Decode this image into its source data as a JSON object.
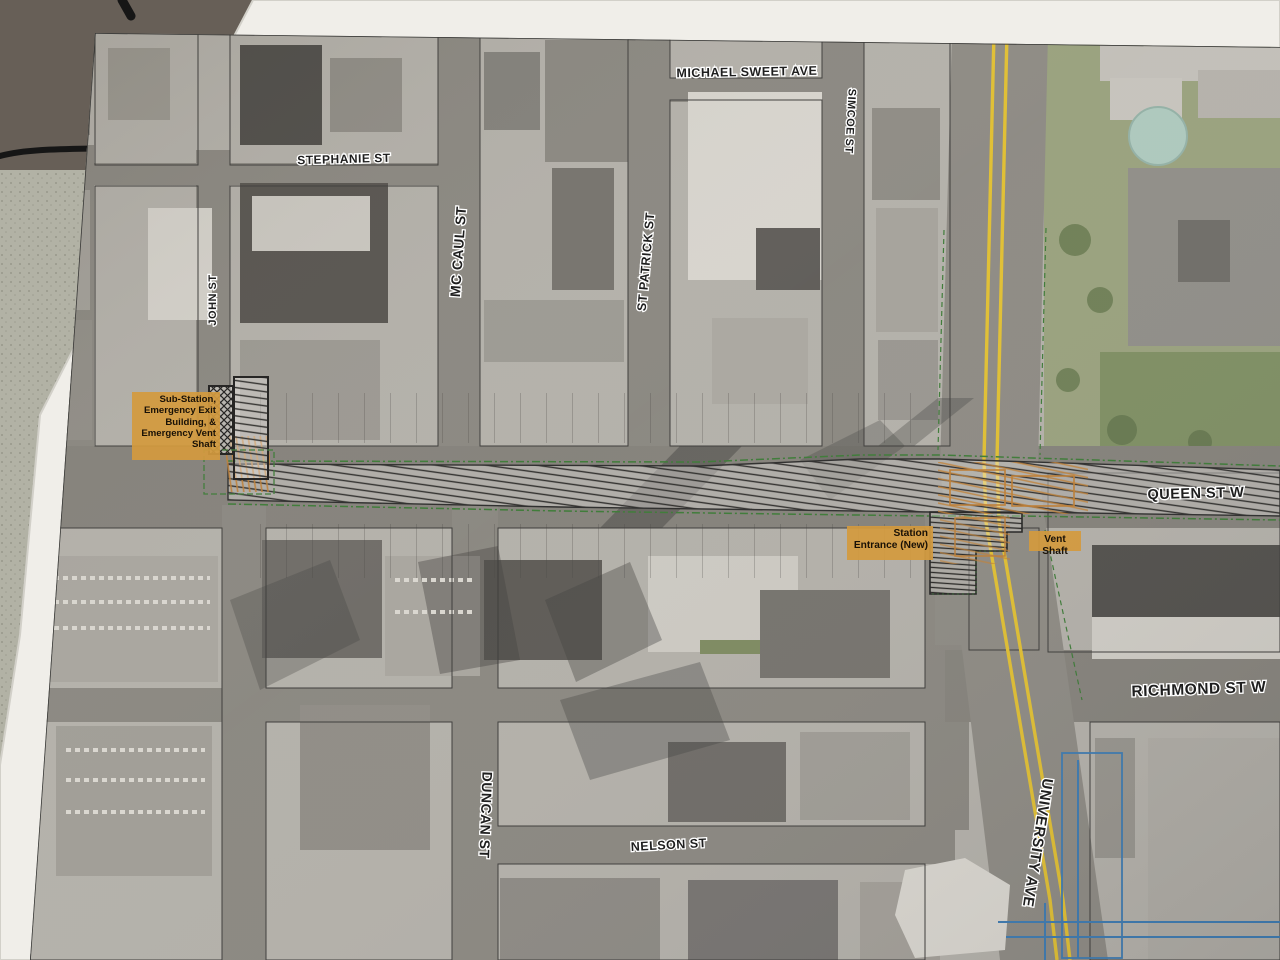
{
  "photo": {
    "description": "Printed aerial transit construction plan (Queen St W corridor, Toronto) photographed lying on a table",
    "paper_color": "#f0eee9"
  },
  "streets": {
    "michael_sweet": "MICHAEL SWEET AVE",
    "stephanie": "STEPHANIE ST",
    "queen": "QUEEN ST W",
    "richmond": "RICHMOND ST W",
    "nelson": "NELSON ST",
    "john": "JOHN ST",
    "mccaul": "MC CAUL ST",
    "st_patrick": "ST PATRICK ST",
    "simcoe": "SIMCOE ST",
    "duncan": "DUNCAN ST",
    "university": "UNIVERSITY AVE"
  },
  "annotations": {
    "substation": "Sub-Station, Emergency Exit Building, & Emergency Vent Shaft",
    "station_entrance": "Station Entrance (New)",
    "vent_shaft": "Vent Shaft"
  },
  "colors": {
    "annotation_bg": "#d39c44",
    "corridor_green": "#3c7a36",
    "road_yellow": "#e0bf32",
    "utility_blue": "#3d7ab0",
    "orange_structure": "#bf7e33",
    "paper": "#f0eee9"
  }
}
